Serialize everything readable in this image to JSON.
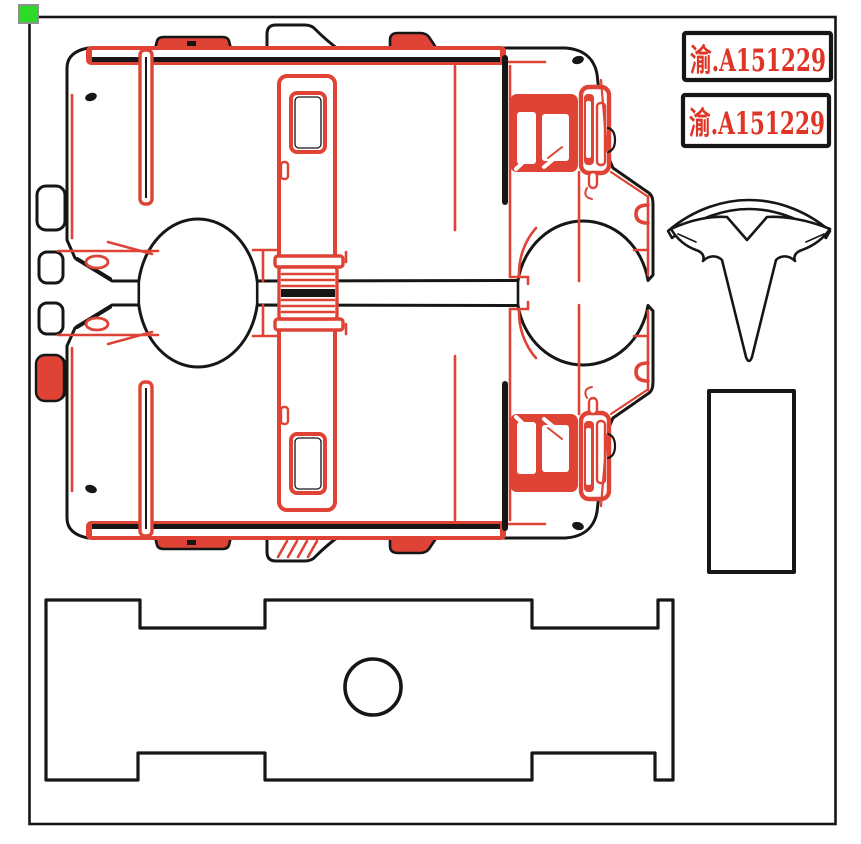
{
  "plates": [
    {
      "text": "渝.A151229"
    },
    {
      "text": "渝.A151229"
    }
  ],
  "colors": {
    "outline_black": "#161616",
    "detail_red": "#de4335",
    "plate_text_red": "#df3527",
    "handle_green": "#2bdb27",
    "handle_border": "#909090",
    "paper": "#ffffff"
  },
  "parts": {
    "handle": "selection-handle",
    "border": "sheet-border",
    "van_top": "delivery-van-profile",
    "van_bottom": "delivery-van-profile-mirrored",
    "plate_1": "license-plate",
    "plate_2": "license-plate",
    "logo": "tesla-t-logo",
    "column": "rectangular-panel",
    "base": "notched-base-plate"
  }
}
